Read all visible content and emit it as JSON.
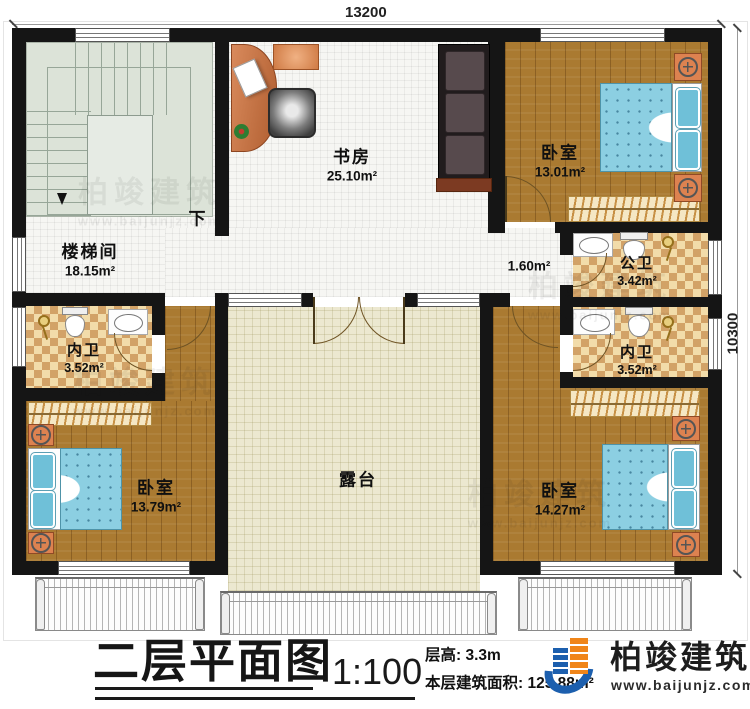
{
  "dimensions": {
    "top": "13200",
    "right": "10300"
  },
  "rooms": {
    "study": {
      "name": "书房",
      "area": "25.10m²"
    },
    "bedroom_top_right": {
      "name": "卧室",
      "area": "13.01m²"
    },
    "stairwell": {
      "name": "楼梯间",
      "area": "18.15m²",
      "down": "下"
    },
    "hall": {
      "area": "1.60m²"
    },
    "public_bath": {
      "name": "公卫",
      "area": "3.42m²"
    },
    "ensuite_left": {
      "name": "内卫",
      "area": "3.52m²"
    },
    "ensuite_right": {
      "name": "内卫",
      "area": "3.52m²"
    },
    "bedroom_bottom_left": {
      "name": "卧室",
      "area": "13.79m²"
    },
    "bedroom_bottom_right": {
      "name": "卧室",
      "area": "14.27m²"
    },
    "terrace": {
      "name": "露台"
    }
  },
  "title_block": {
    "title": "二层平面图",
    "scale": "1:100",
    "floor_height": "层高: 3.3m",
    "floor_area": "本层建筑面积: 125.88m²"
  },
  "brand": {
    "name": "柏竣建筑",
    "website": "www.baijunjz.com"
  },
  "watermark": {
    "text": "柏竣建筑",
    "website": "www.baijunjz.com"
  },
  "colors": {
    "wall": "#151515",
    "wood_floor": "#aa7a31",
    "checker_light": "#f2dcaa",
    "checker_dark": "#d2a267",
    "terrace_floor": "#ece8d0",
    "bed_blue": "#8ccfe2",
    "brand_blue": "#1c5fae",
    "brand_orange": "#f08519"
  }
}
